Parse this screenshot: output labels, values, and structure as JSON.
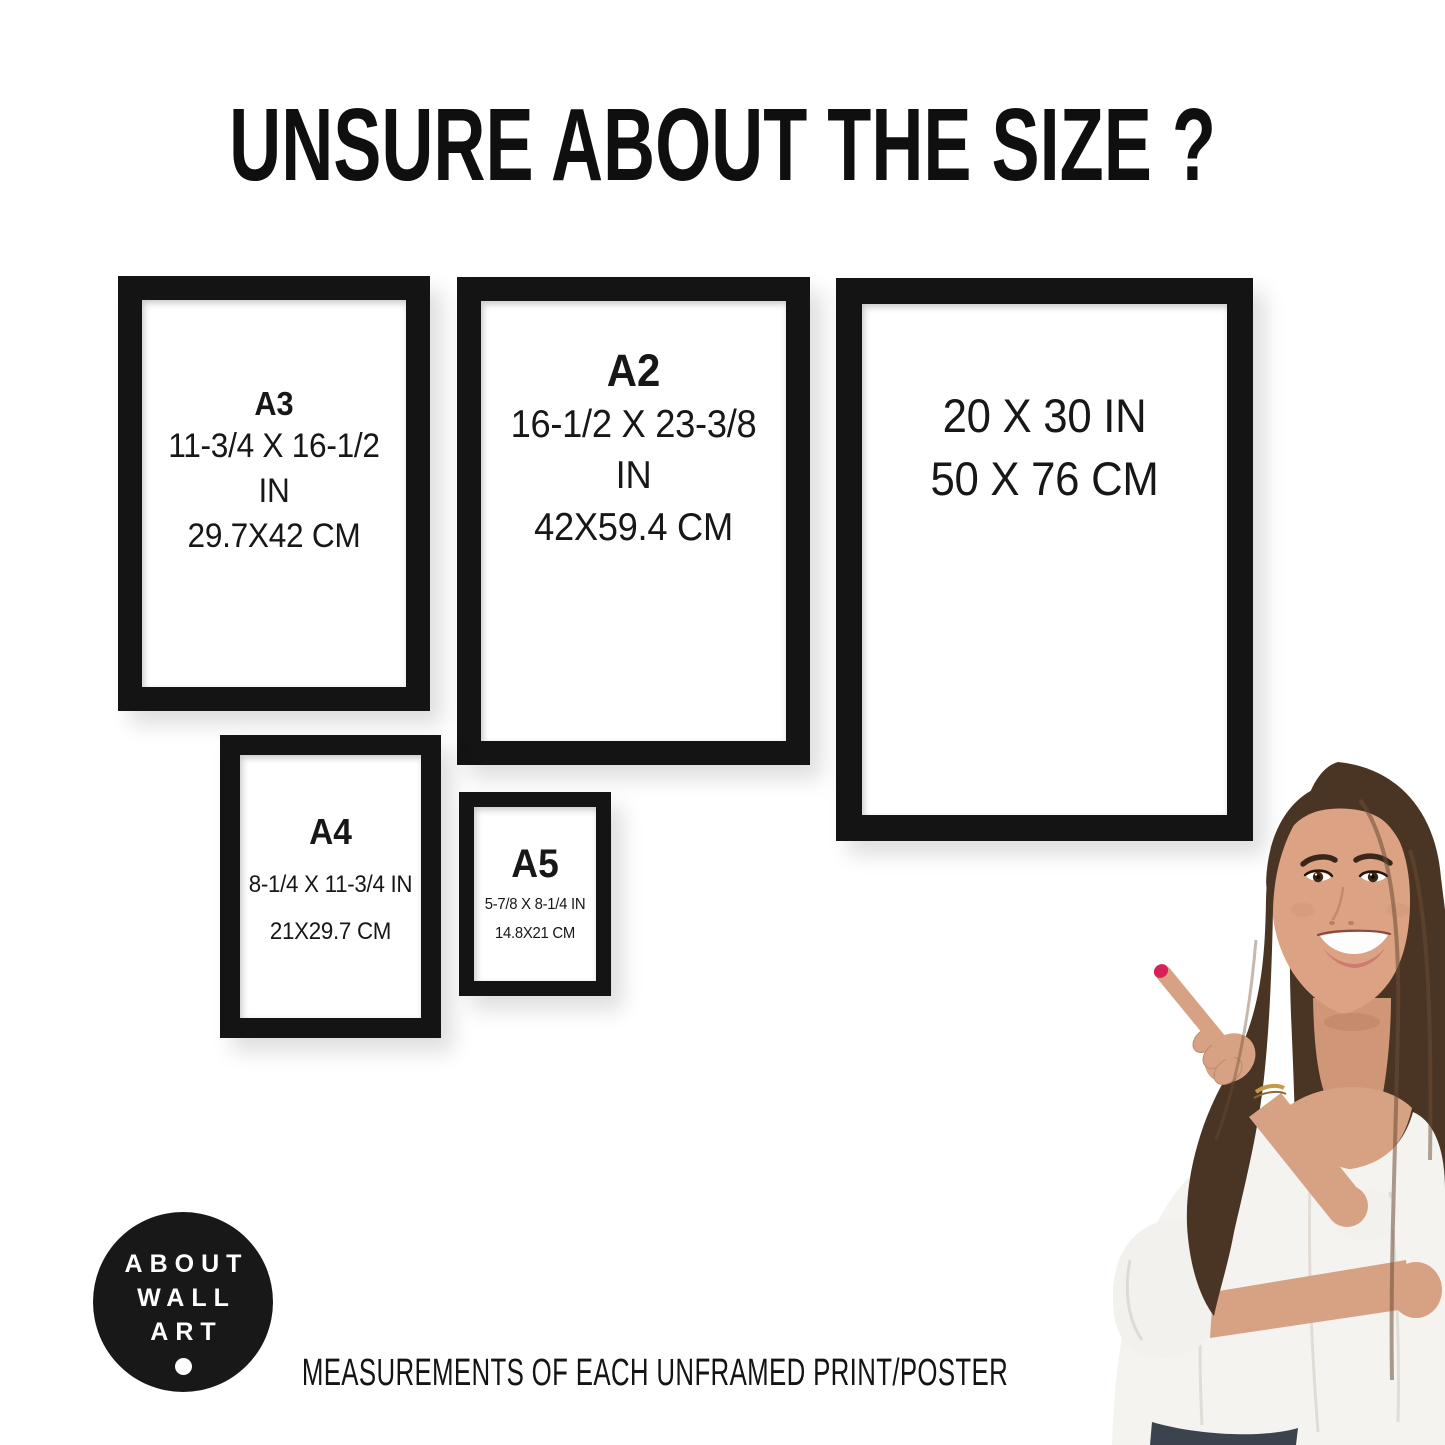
{
  "header": {
    "title": "UNSURE ABOUT THE SIZE ?"
  },
  "frames": [
    {
      "size_label": "A3",
      "inches": "11-3/4 X 16-1/2 IN",
      "cm": "29.7X42 CM"
    },
    {
      "size_label": "A2",
      "inches": "16-1/2 X 23-3/8 IN",
      "cm": "42X59.4 CM"
    },
    {
      "inches": "20 X 30 IN",
      "cm": "50 X 76 CM"
    },
    {
      "size_label": "A4",
      "inches": "8-1/4 X 11-3/4 IN",
      "cm": "21X29.7 CM"
    },
    {
      "size_label": "A5",
      "inches": "5-7/8 X 8-1/4 IN",
      "cm": "14.8X21 CM"
    }
  ],
  "logo": {
    "lines": [
      "ABOUT",
      "WALL",
      "ART"
    ]
  },
  "footer": {
    "text": "MEASUREMENTS OF EACH UNFRAMED PRINT/POSTER"
  },
  "colors": {
    "frame_black": "#141414",
    "logo_black": "#181818",
    "hair_brown": "#4a3423",
    "skin": "#d7a183",
    "blouse_white": "#f5f3f0",
    "nail_red": "#d8205a"
  }
}
